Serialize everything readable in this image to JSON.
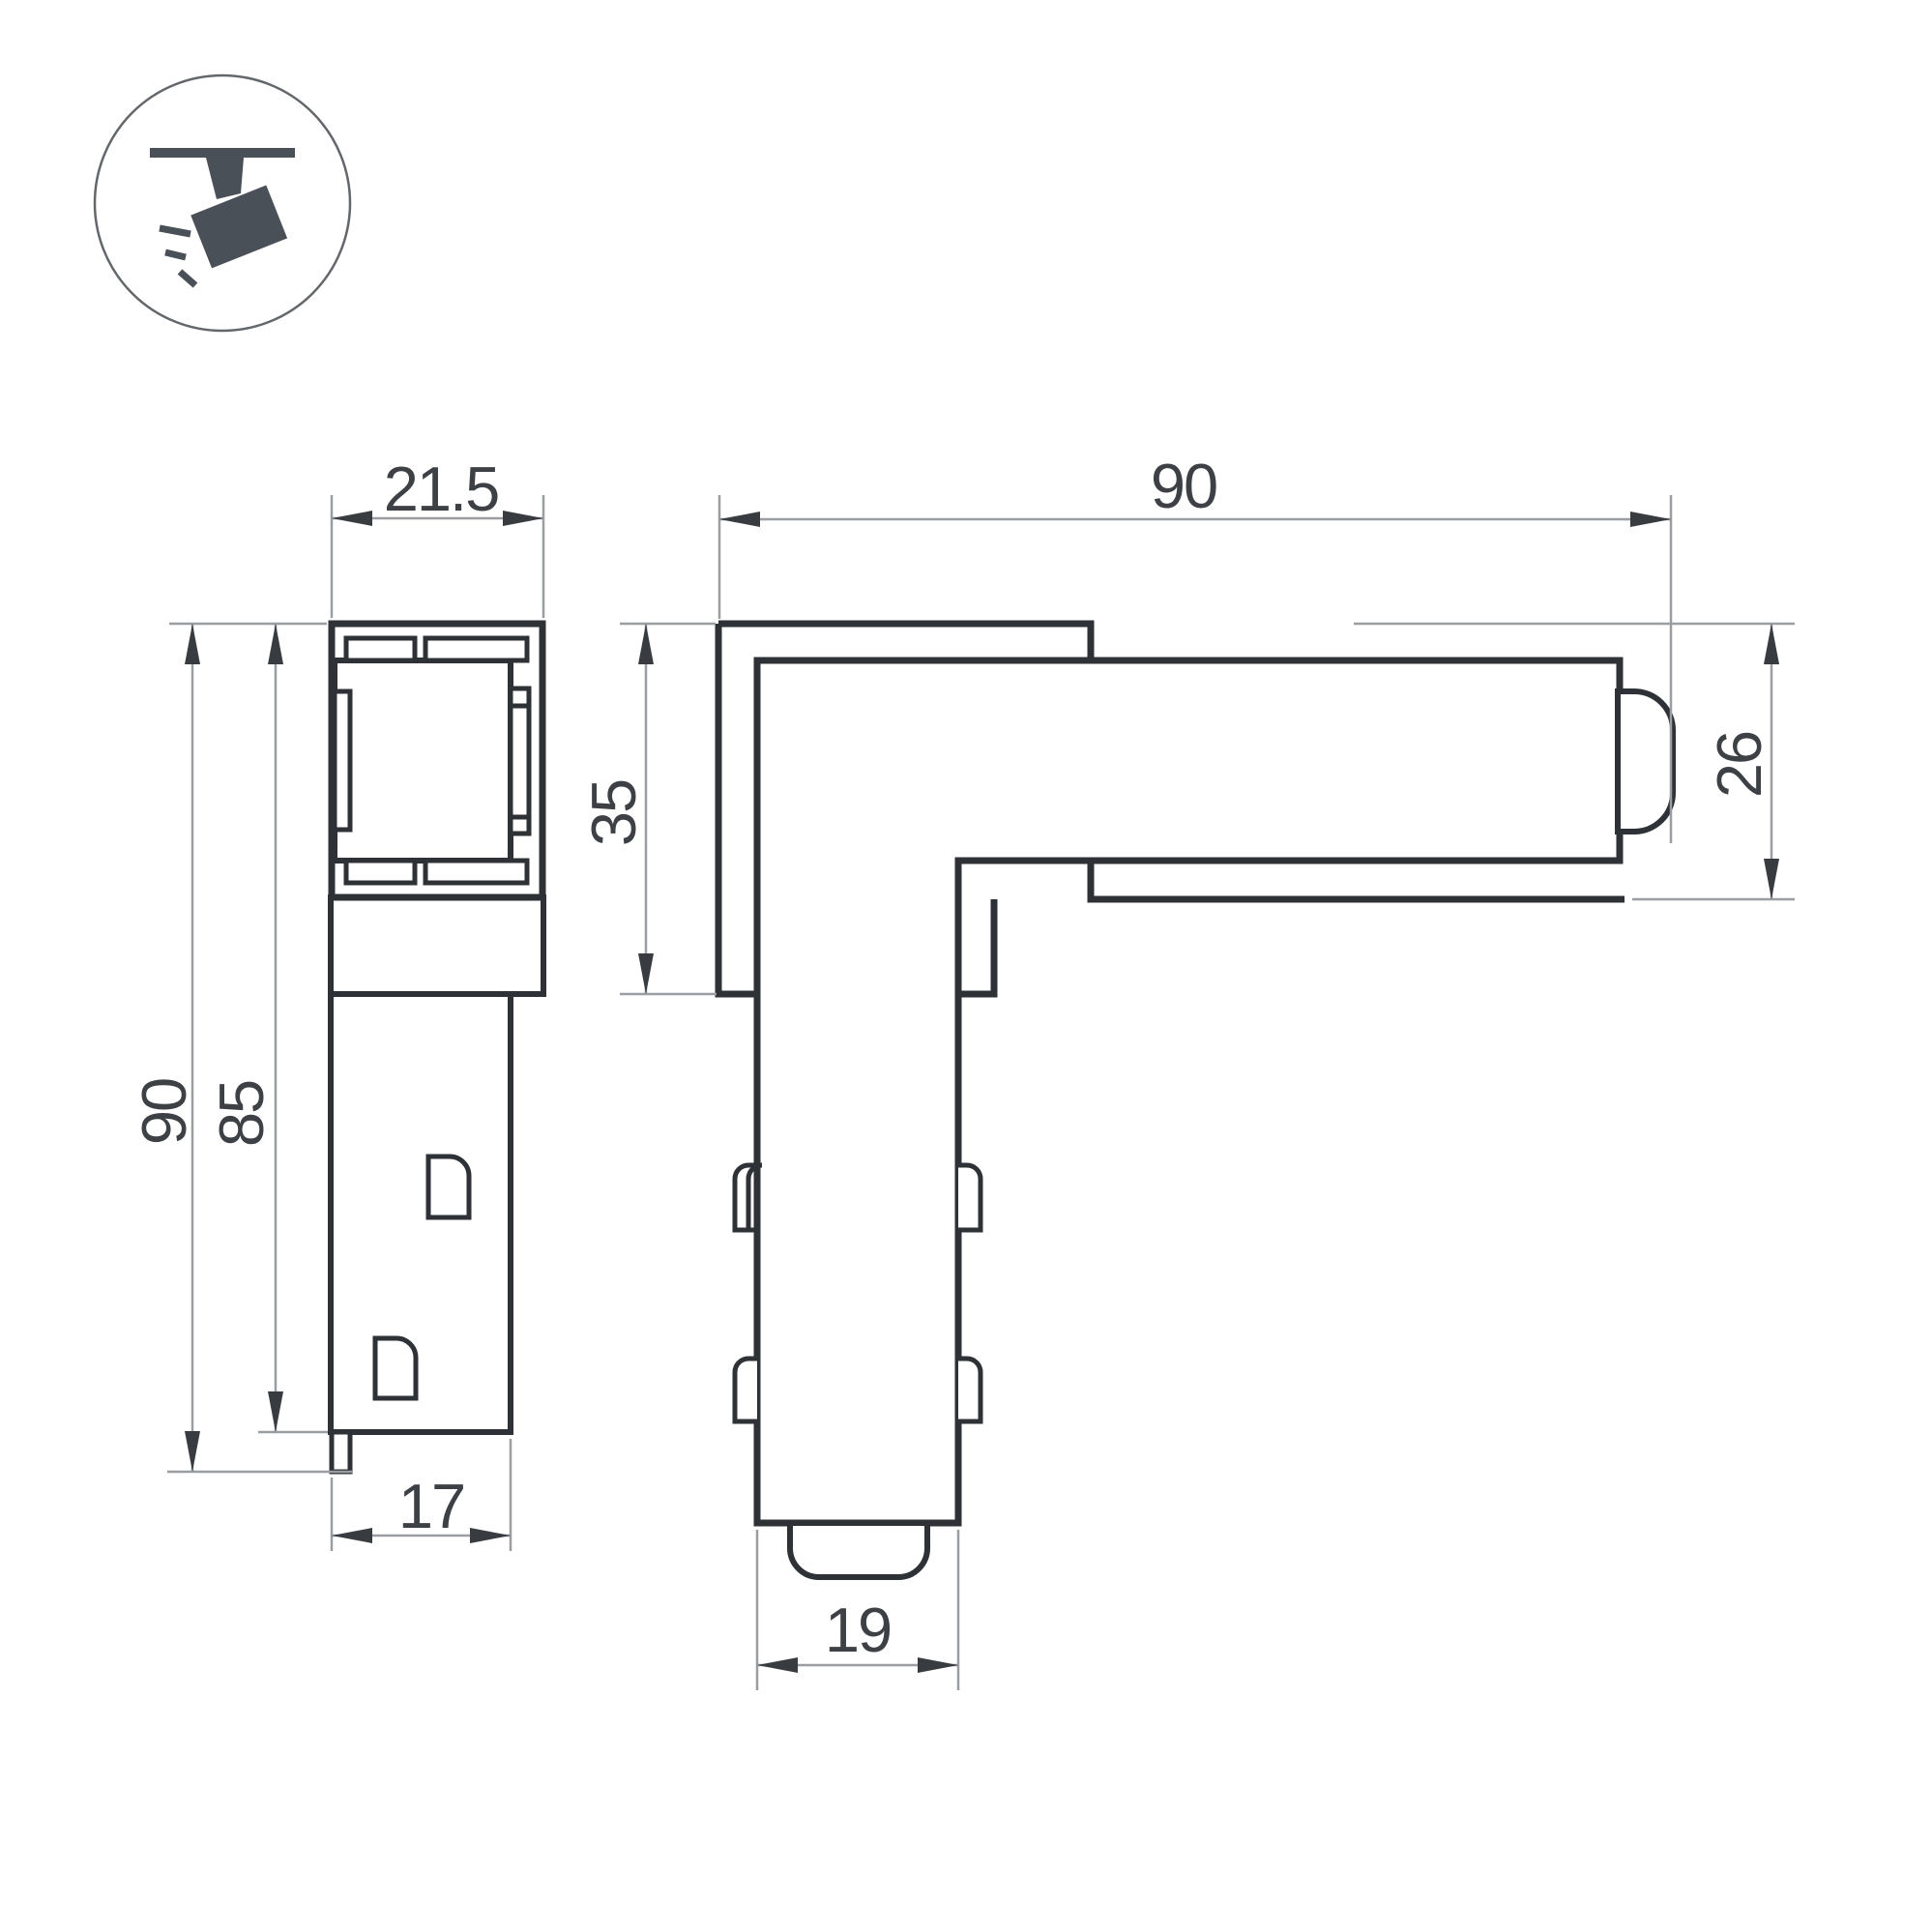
{
  "badge": {
    "icon": "track-spotlight"
  },
  "colors": {
    "outline": "#2e3135",
    "dimension_text": "#3d4045",
    "arrow": "#383b3f",
    "line_light": "#9a9ea1",
    "icon": "#495057",
    "badge_ring": "#63676b",
    "background": "#ffffff"
  },
  "dimensions": {
    "front_view": {
      "top_width": "21.5",
      "total_height": "90",
      "body_height": "85",
      "bottom_width": "17"
    },
    "side_view": {
      "length": "90",
      "corner_height": "35",
      "plate_height": "26",
      "leg_width": "19"
    }
  }
}
